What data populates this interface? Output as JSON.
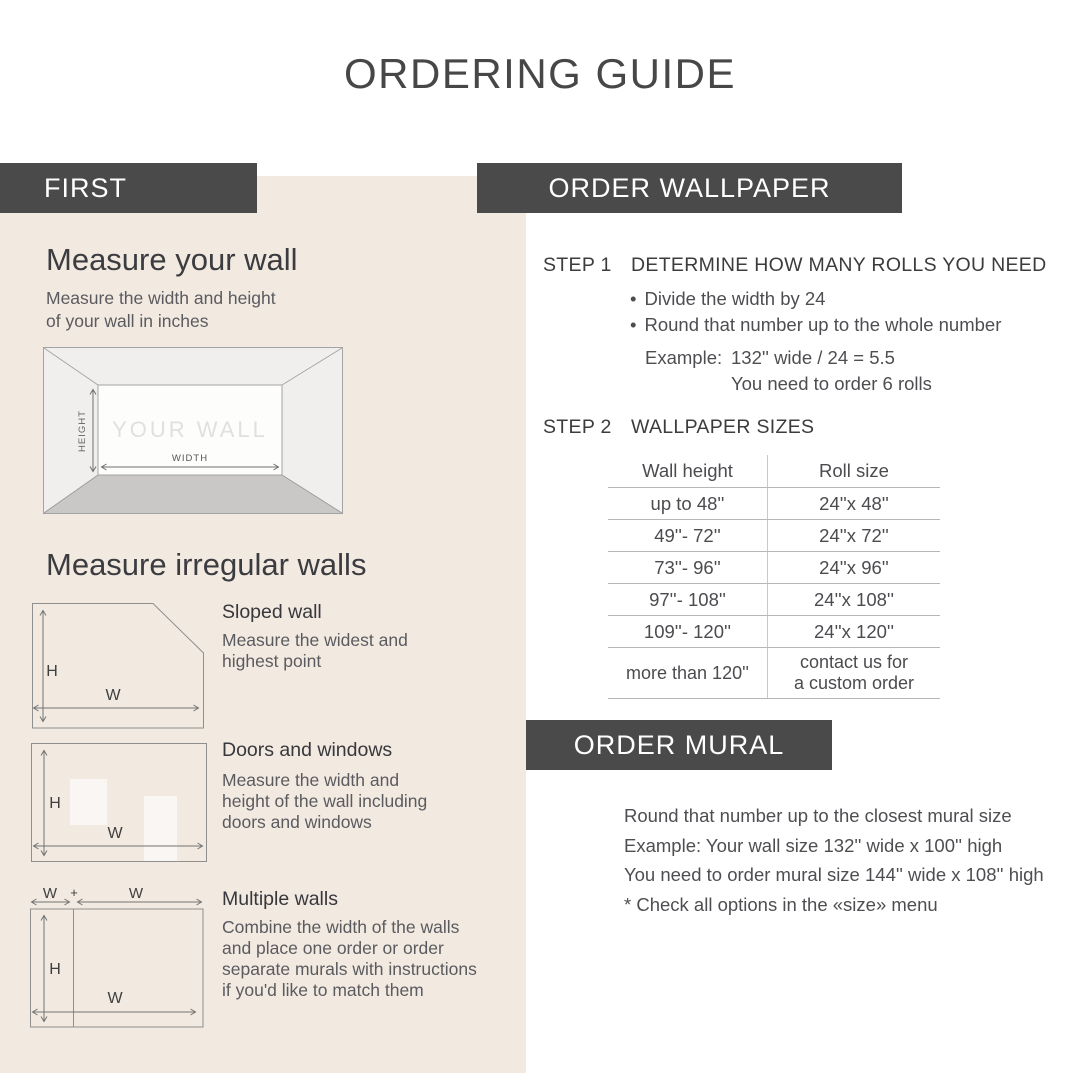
{
  "page": {
    "title": "ORDERING GUIDE"
  },
  "colors": {
    "panel_bg": "#F2E9E1",
    "bar_bg": "#4A4A4A",
    "bar_text": "#FFFFFF",
    "heading_text": "#3B3C40",
    "body_text": "#5A5B5F",
    "diagram_line": "#8F8F8F",
    "room_floor": "#C9C8C6",
    "room_walls": "#F0EFED",
    "wall_watermark": "#E2E0DC",
    "table_line": "#B6B6B6"
  },
  "first": {
    "header": "FIRST",
    "measure_wall": {
      "heading": "Measure your wall",
      "body": "Measure the width and height\nof your wall in inches"
    },
    "room_diagram": {
      "wall_label": "YOUR WALL",
      "height_label": "HEIGHT",
      "width_label": "WIDTH"
    },
    "irregular": {
      "heading": "Measure irregular walls",
      "items": [
        {
          "title": "Sloped wall",
          "body": "Measure the widest and\nhighest point",
          "h_label": "H",
          "w_label": "W"
        },
        {
          "title": "Doors and windows",
          "body": "Measure the width and\nheight of the wall including\ndoors and windows",
          "h_label": "H",
          "w_label": "W"
        },
        {
          "title": "Multiple walls",
          "body": "Combine the width of the walls\nand place one order or order\nseparate murals with instructions\nif you'd like to match them",
          "h_label": "H",
          "w_label": "W",
          "w_top_left": "W",
          "plus": "+",
          "w_top_right": "W"
        }
      ]
    }
  },
  "wallpaper": {
    "header": "ORDER WALLPAPER",
    "step1": {
      "label": "STEP 1",
      "heading": "DETERMINE HOW MANY ROLLS YOU NEED",
      "bullets": [
        "Divide the width by 24",
        "Round that number up to the whole number"
      ],
      "example": {
        "label": "Example:",
        "line1": "132'' wide / 24 = 5.5",
        "line2": "You need to order 6 rolls"
      }
    },
    "step2": {
      "label": "STEP 2",
      "heading": "WALLPAPER SIZES",
      "table": {
        "columns": [
          "Wall height",
          "Roll size"
        ],
        "rows": [
          [
            "up to 48''",
            "24''x 48''"
          ],
          [
            "49''- 72''",
            "24''x 72''"
          ],
          [
            "73''- 96''",
            "24''x 96''"
          ],
          [
            "97''- 108''",
            "24''x 108''"
          ],
          [
            "109''- 120''",
            "24''x 120''"
          ],
          [
            "more than 120''",
            "contact us for\na custom order"
          ]
        ]
      }
    }
  },
  "mural": {
    "header": "ORDER MURAL",
    "lines": [
      "Round that number up to the closest mural size",
      "Example: Your wall size 132'' wide x 100'' high",
      "You need to order mural size 144'' wide x 108'' high",
      "* Check all options in the «size» menu"
    ]
  }
}
